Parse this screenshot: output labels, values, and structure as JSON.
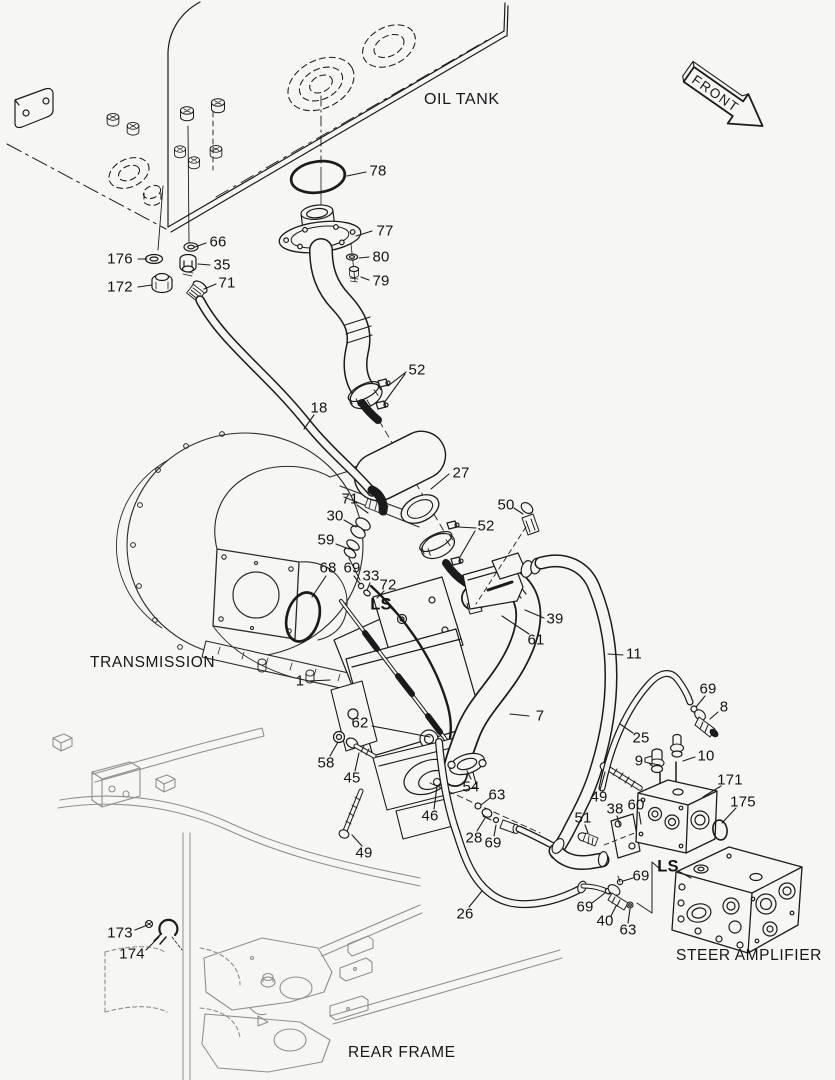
{
  "colors": {
    "background": "#f6f6f4",
    "line": "#1b1b1b",
    "frame_line": "#8f8f8f"
  },
  "front_arrow": {
    "text": "FRONT"
  },
  "section_labels": [
    {
      "id": "oil-tank",
      "text": "OIL TANK",
      "x": 424,
      "y": 91,
      "big": true
    },
    {
      "id": "transmission",
      "text": "TRANSMISSION",
      "x": 90,
      "y": 654
    },
    {
      "id": "rear-frame",
      "text": "REAR FRAME",
      "x": 348,
      "y": 1044
    },
    {
      "id": "steer-amplifier",
      "text": "STEER AMPLIFIER",
      "x": 676,
      "y": 947
    }
  ],
  "part_labels": [
    {
      "id": "78",
      "text": "78",
      "x": 378,
      "y": 171,
      "leaders": [
        [
          [
            366,
            172
          ],
          [
            347,
            176
          ]
        ]
      ]
    },
    {
      "id": "77",
      "text": "77",
      "x": 385,
      "y": 231,
      "leaders": [
        [
          [
            372,
            231
          ],
          [
            356,
            236
          ]
        ]
      ]
    },
    {
      "id": "80",
      "text": "80",
      "x": 381,
      "y": 257,
      "leaders": [
        [
          [
            369,
            257
          ],
          [
            359,
            258
          ]
        ]
      ]
    },
    {
      "id": "79",
      "text": "79",
      "x": 381,
      "y": 281,
      "leaders": [
        [
          [
            369,
            280
          ],
          [
            361,
            277
          ]
        ]
      ]
    },
    {
      "id": "66",
      "text": "66",
      "x": 218,
      "y": 242,
      "leaders": [
        [
          [
            206,
            243
          ],
          [
            195,
            247
          ]
        ]
      ]
    },
    {
      "id": "176",
      "text": "176",
      "x": 120,
      "y": 259,
      "leaders": [
        [
          [
            138,
            259
          ],
          [
            147,
            259
          ]
        ]
      ]
    },
    {
      "id": "35",
      "text": "35",
      "x": 222,
      "y": 265,
      "leaders": [
        [
          [
            210,
            265
          ],
          [
            198,
            264
          ]
        ]
      ]
    },
    {
      "id": "172",
      "text": "172",
      "x": 120,
      "y": 287,
      "leaders": [
        [
          [
            138,
            287
          ],
          [
            152,
            285
          ]
        ]
      ]
    },
    {
      "id": "71-a",
      "text": "71",
      "x": 227,
      "y": 283,
      "leaders": [
        [
          [
            216,
            284
          ],
          [
            204,
            289
          ]
        ]
      ]
    },
    {
      "id": "52-a",
      "text": "52",
      "x": 417,
      "y": 370,
      "leaders": [
        [
          [
            406,
            372
          ],
          [
            388,
            386
          ]
        ],
        [
          [
            405,
            374
          ],
          [
            384,
            403
          ]
        ]
      ]
    },
    {
      "id": "18",
      "text": "18",
      "x": 319,
      "y": 408,
      "leaders": [
        [
          [
            314,
            415
          ],
          [
            304,
            429
          ]
        ]
      ]
    },
    {
      "id": "27",
      "text": "27",
      "x": 461,
      "y": 473,
      "leaders": [
        [
          [
            449,
            474
          ],
          [
            431,
            489
          ]
        ]
      ]
    },
    {
      "id": "71-b",
      "text": "71",
      "x": 350,
      "y": 499,
      "leaders": [
        [
          [
            357,
            505
          ],
          [
            368,
            513
          ]
        ]
      ]
    },
    {
      "id": "30",
      "text": "30",
      "x": 335,
      "y": 516,
      "leaders": [
        [
          [
            344,
            520
          ],
          [
            356,
            527
          ]
        ]
      ]
    },
    {
      "id": "59",
      "text": "59",
      "x": 326,
      "y": 540,
      "leaders": [
        [
          [
            336,
            544
          ],
          [
            349,
            549
          ]
        ]
      ]
    },
    {
      "id": "68",
      "text": "68",
      "x": 328,
      "y": 568,
      "leaders": [
        [
          [
            326,
            576
          ],
          [
            312,
            597
          ]
        ]
      ]
    },
    {
      "id": "69-a",
      "text": "69",
      "x": 352,
      "y": 568,
      "leaders": [
        [
          [
            354,
            576
          ],
          [
            360,
            584
          ]
        ]
      ]
    },
    {
      "id": "33",
      "text": "33",
      "x": 371,
      "y": 576,
      "leaders": [
        [
          [
            370,
            583
          ],
          [
            367,
            590
          ]
        ]
      ]
    },
    {
      "id": "72",
      "text": "72",
      "x": 388,
      "y": 585,
      "leaders": [
        [
          [
            384,
            591
          ],
          [
            377,
            598
          ]
        ]
      ]
    },
    {
      "id": "ls-pump",
      "text": "LS",
      "x": 381,
      "y": 605,
      "bold": true,
      "leaders": [
        [
          [
            391,
            608
          ],
          [
            400,
            617
          ]
        ]
      ]
    },
    {
      "id": "50",
      "text": "50",
      "x": 506,
      "y": 505,
      "leaders": [
        [
          [
            514,
            508
          ],
          [
            523,
            514
          ]
        ]
      ]
    },
    {
      "id": "52-b",
      "text": "52",
      "x": 486,
      "y": 526,
      "leaders": [
        [
          [
            476,
            528
          ],
          [
            458,
            527
          ]
        ],
        [
          [
            475,
            531
          ],
          [
            460,
            557
          ]
        ]
      ]
    },
    {
      "id": "39",
      "text": "39",
      "x": 555,
      "y": 619,
      "leaders": [
        [
          [
            544,
            618
          ],
          [
            525,
            610
          ]
        ]
      ]
    },
    {
      "id": "61",
      "text": "61",
      "x": 536,
      "y": 640,
      "leaders": [
        [
          [
            529,
            634
          ],
          [
            502,
            616
          ]
        ]
      ]
    },
    {
      "id": "11",
      "text": "11",
      "x": 634,
      "y": 654,
      "leaders": [
        [
          [
            623,
            655
          ],
          [
            608,
            654
          ]
        ]
      ]
    },
    {
      "id": "7",
      "text": "7",
      "x": 540,
      "y": 716,
      "leaders": [
        [
          [
            529,
            716
          ],
          [
            510,
            714
          ]
        ]
      ]
    },
    {
      "id": "25",
      "text": "25",
      "x": 641,
      "y": 738,
      "leaders": [
        [
          [
            633,
            733
          ],
          [
            620,
            724
          ]
        ]
      ]
    },
    {
      "id": "69-c",
      "text": "69",
      "x": 708,
      "y": 689,
      "leaders": [
        [
          [
            705,
            696
          ],
          [
            696,
            707
          ]
        ]
      ]
    },
    {
      "id": "8",
      "text": "8",
      "x": 724,
      "y": 707,
      "leaders": [
        [
          [
            718,
            712
          ],
          [
            710,
            719
          ]
        ]
      ]
    },
    {
      "id": "9",
      "text": "9",
      "x": 639,
      "y": 761,
      "leaders": [
        [
          [
            648,
            763
          ],
          [
            660,
            765
          ]
        ]
      ]
    },
    {
      "id": "10",
      "text": "10",
      "x": 706,
      "y": 756,
      "leaders": [
        [
          [
            695,
            757
          ],
          [
            683,
            761
          ]
        ]
      ]
    },
    {
      "id": "171",
      "text": "171",
      "x": 730,
      "y": 780,
      "leaders": [
        [
          [
            721,
            786
          ],
          [
            703,
            797
          ]
        ]
      ]
    },
    {
      "id": "175",
      "text": "175",
      "x": 743,
      "y": 802,
      "leaders": [
        [
          [
            736,
            808
          ],
          [
            722,
            823
          ]
        ]
      ]
    },
    {
      "id": "49-b",
      "text": "49",
      "x": 599,
      "y": 797,
      "leaders": [
        [
          [
            600,
            790
          ],
          [
            605,
            772
          ]
        ]
      ]
    },
    {
      "id": "38",
      "text": "38",
      "x": 615,
      "y": 809,
      "leaders": [
        [
          [
            617,
            816
          ],
          [
            620,
            826
          ]
        ]
      ]
    },
    {
      "id": "60",
      "text": "60",
      "x": 636,
      "y": 805,
      "leaders": [
        [
          [
            639,
            812
          ],
          [
            641,
            824
          ]
        ]
      ]
    },
    {
      "id": "51",
      "text": "51",
      "x": 583,
      "y": 818,
      "leaders": [
        [
          [
            585,
            825
          ],
          [
            588,
            833
          ]
        ]
      ]
    },
    {
      "id": "1",
      "text": "1",
      "x": 300,
      "y": 681,
      "leaders": [
        [
          [
            308,
            681
          ],
          [
            330,
            680
          ]
        ]
      ]
    },
    {
      "id": "62",
      "text": "62",
      "x": 360,
      "y": 723,
      "leaders": [
        [
          [
            372,
            726
          ],
          [
            430,
            737
          ]
        ]
      ]
    },
    {
      "id": "58",
      "text": "58",
      "x": 326,
      "y": 763,
      "leaders": [
        [
          [
            330,
            756
          ],
          [
            338,
            742
          ]
        ]
      ]
    },
    {
      "id": "45",
      "text": "45",
      "x": 352,
      "y": 778,
      "leaders": [
        [
          [
            355,
            771
          ],
          [
            359,
            753
          ]
        ]
      ]
    },
    {
      "id": "49-a",
      "text": "49",
      "x": 364,
      "y": 853,
      "leaders": [
        [
          [
            362,
            846
          ],
          [
            352,
            835
          ]
        ]
      ]
    },
    {
      "id": "46",
      "text": "46",
      "x": 430,
      "y": 816,
      "leaders": [
        [
          [
            434,
            809
          ],
          [
            437,
            786
          ]
        ]
      ]
    },
    {
      "id": "54",
      "text": "54",
      "x": 471,
      "y": 787,
      "leaders": [
        [
          [
            471,
            779
          ],
          [
            467,
            771
          ]
        ]
      ]
    },
    {
      "id": "63-a",
      "text": "63",
      "x": 497,
      "y": 795,
      "leaders": [
        [
          [
            490,
            798
          ],
          [
            481,
            805
          ]
        ]
      ]
    },
    {
      "id": "28",
      "text": "28",
      "x": 474,
      "y": 838,
      "leaders": [
        [
          [
            477,
            831
          ],
          [
            485,
            818
          ]
        ]
      ]
    },
    {
      "id": "69-b",
      "text": "69",
      "x": 493,
      "y": 843,
      "leaders": [
        [
          [
            494,
            836
          ],
          [
            496,
            825
          ]
        ]
      ]
    },
    {
      "id": "26",
      "text": "26",
      "x": 465,
      "y": 914,
      "leaders": [
        [
          [
            469,
            907
          ],
          [
            482,
            891
          ]
        ]
      ]
    },
    {
      "id": "ls-amp",
      "text": "LS",
      "x": 668,
      "y": 867,
      "bold": true,
      "leaders": [
        [
          [
            678,
            871
          ],
          [
            691,
            878
          ]
        ]
      ]
    },
    {
      "id": "69-d",
      "text": "69",
      "x": 641,
      "y": 876,
      "leaders": [
        [
          [
            633,
            878
          ],
          [
            623,
            881
          ]
        ]
      ]
    },
    {
      "id": "69-e",
      "text": "69",
      "x": 585,
      "y": 907,
      "leaders": [
        [
          [
            592,
            903
          ],
          [
            605,
            893
          ]
        ]
      ]
    },
    {
      "id": "40",
      "text": "40",
      "x": 605,
      "y": 921,
      "leaders": [
        [
          [
            611,
            916
          ],
          [
            616,
            906
          ]
        ]
      ]
    },
    {
      "id": "63-b",
      "text": "63",
      "x": 628,
      "y": 930,
      "leaders": [
        [
          [
            628,
            923
          ],
          [
            630,
            909
          ]
        ]
      ]
    },
    {
      "id": "173",
      "text": "173",
      "x": 120,
      "y": 933,
      "leaders": [
        [
          [
            135,
            930
          ],
          [
            145,
            926
          ]
        ]
      ]
    },
    {
      "id": "174",
      "text": "174",
      "x": 132,
      "y": 954,
      "leaders": [
        [
          [
            146,
            950
          ],
          [
            159,
            937
          ]
        ]
      ]
    }
  ]
}
